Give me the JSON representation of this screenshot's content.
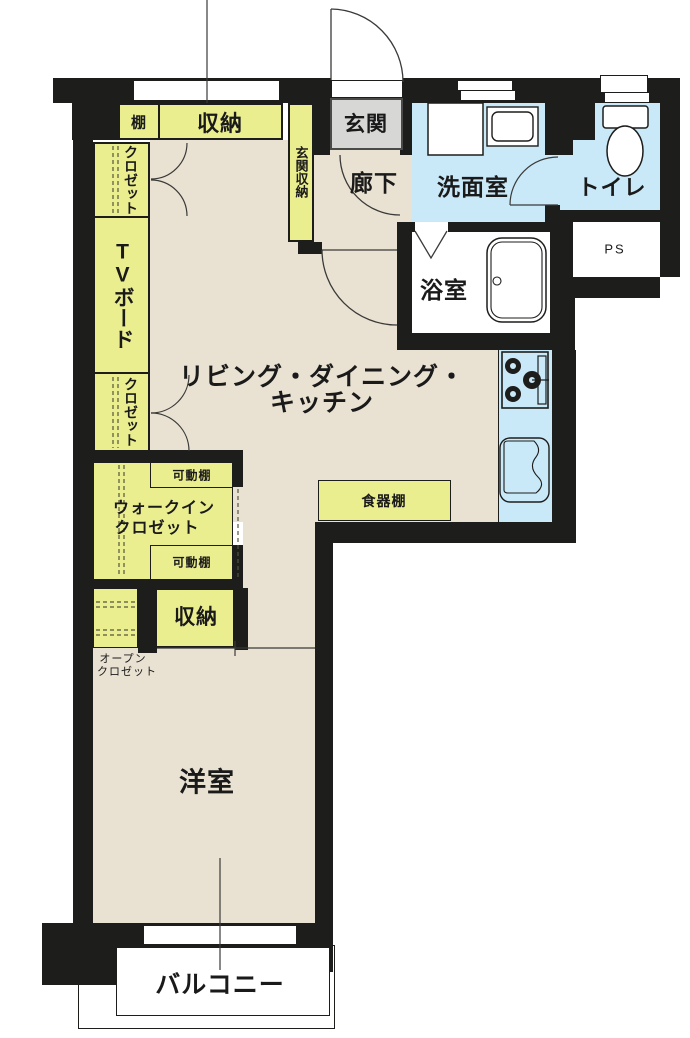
{
  "plan_title": "1LDK apartment floor plan",
  "colors": {
    "wall": "#1d1d1b",
    "floor_beige": "#e9e2d2",
    "storage_yellow": "#eaee8f",
    "wet_area_blue": "#c9e9f8",
    "entrance_gray": "#d7d7d6",
    "outside_white": "#ffffff"
  },
  "labels": {
    "ldk_line1": "リビング・ダイニング・",
    "ldk_line2": "キッチン",
    "western_room": "洋室",
    "balcony": "バルコニー",
    "hallway": "廊下",
    "entrance": "玄関",
    "entrance_storage": "玄関収納",
    "washroom": "洗面室",
    "toilet": "トイレ",
    "bathroom": "浴室",
    "pipe_space": "PS",
    "shelf": "棚",
    "storage_top": "収納",
    "closet_upper": "クロゼット",
    "tv_board": "TVボード",
    "closet_lower": "クロゼット",
    "walk_in_closet_line1": "ウォークイン",
    "walk_in_closet_line2": "クロゼット",
    "movable_shelf_top": "可動棚",
    "movable_shelf_bottom": "可動棚",
    "cupboard": "食器棚",
    "storage_lower": "収納",
    "open_closet_line1": "オープン",
    "open_closet_line2": "クロゼット"
  },
  "icons": {
    "bathtub": "bathtub-icon",
    "toilet": "toilet-icon",
    "stove": "stove-icon",
    "kitchen_sink": "kitchen-sink-icon",
    "washer": "washing-machine-icon",
    "vanity_sink": "vanity-sink-icon",
    "door_arcs": "door-swing-icon",
    "folding_door": "folding-door-icon"
  }
}
